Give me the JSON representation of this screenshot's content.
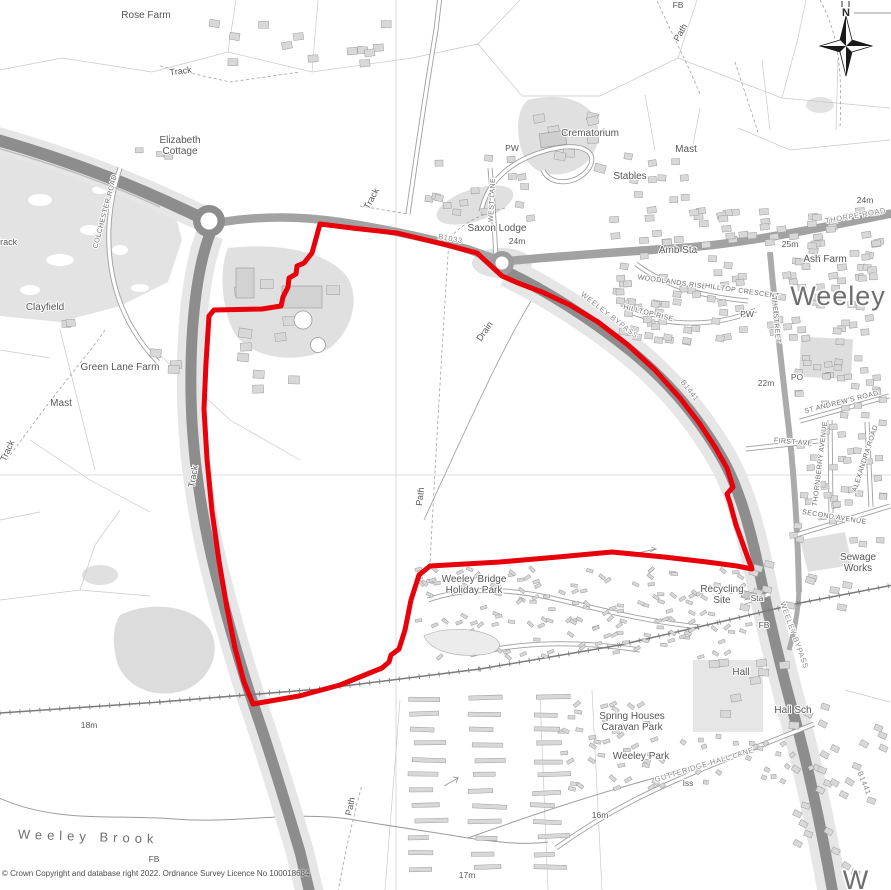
{
  "map": {
    "region_name": "Weeley",
    "copyright": "© Crown Copyright and database right 2022. Ordnance Survey Licence No 100018684",
    "compass": {
      "letter": "N"
    },
    "colors": {
      "boundary_red": "#e8000b",
      "road_major": "#8d8d8d",
      "road_secondary": "#a2a2a2",
      "verge_grey": "#e6e6e6",
      "building_grey": "#d8d8d8",
      "label_grey": "#575757"
    },
    "labels": [
      {
        "t": "Rose Farm",
        "x": 146,
        "y": 18
      },
      {
        "t": "Track",
        "x": 181,
        "y": 74,
        "r": -8,
        "s": 9
      },
      {
        "t": "Elizabeth\nCottage",
        "x": 180,
        "y": 143
      },
      {
        "t": "FB",
        "x": 678,
        "y": 8,
        "c": "small"
      },
      {
        "t": "Path",
        "x": 683,
        "y": 34,
        "r": -60,
        "s": 9
      },
      {
        "t": "Crematorium",
        "x": 590,
        "y": 136
      },
      {
        "t": "Mast",
        "x": 686,
        "y": 152
      },
      {
        "t": "Stables",
        "x": 630,
        "y": 179
      },
      {
        "t": "PW",
        "x": 512,
        "y": 151,
        "c": "small"
      },
      {
        "t": "Saxon Lodge",
        "x": 497,
        "y": 231
      },
      {
        "t": "24m",
        "x": 517,
        "y": 244,
        "c": "small"
      },
      {
        "t": "Amb Sta",
        "x": 678,
        "y": 253
      },
      {
        "t": "Ash Farm",
        "x": 825,
        "y": 262
      },
      {
        "t": "Weeley",
        "x": 838,
        "y": 305,
        "c": "big"
      },
      {
        "t": "WOODLANDS RISE",
        "x": 672,
        "y": 284,
        "r": 8,
        "c": "street"
      },
      {
        "t": "HILLTOP CRESCENT",
        "x": 742,
        "y": 293,
        "r": 8,
        "c": "street"
      },
      {
        "t": "HILLTOP RISE",
        "x": 648,
        "y": 315,
        "r": 14,
        "c": "street"
      },
      {
        "t": "PW",
        "x": 747,
        "y": 317,
        "c": "small"
      },
      {
        "t": "THE STREET",
        "x": 774,
        "y": 320,
        "r": 85,
        "c": "street"
      },
      {
        "t": "WEELEY BYPASS",
        "x": 608,
        "y": 317,
        "r": 38,
        "c": "road"
      },
      {
        "t": "B1033",
        "x": 450,
        "y": 241,
        "r": 10,
        "c": "road"
      },
      {
        "t": "25m",
        "x": 790,
        "y": 247,
        "c": "small"
      },
      {
        "t": "THORPE ROAD",
        "x": 856,
        "y": 218,
        "r": -10,
        "c": "road"
      },
      {
        "t": "24m",
        "x": 865,
        "y": 203,
        "c": "small"
      },
      {
        "t": "ST ANDREW'S ROAD",
        "x": 842,
        "y": 404,
        "r": -14,
        "c": "street"
      },
      {
        "t": "FIRST AVE",
        "x": 793,
        "y": 444,
        "r": 5,
        "c": "street"
      },
      {
        "t": "THORNBERRY AVENUE",
        "x": 822,
        "y": 464,
        "r": -83,
        "c": "street"
      },
      {
        "t": "ALEXANDRA ROAD",
        "x": 867,
        "y": 459,
        "r": -72,
        "c": "street"
      },
      {
        "t": "SECOND AVENUE",
        "x": 834,
        "y": 519,
        "r": 9,
        "c": "street"
      },
      {
        "t": "Sewage\nWorks",
        "x": 858,
        "y": 560
      },
      {
        "t": "Recycling\nSite",
        "x": 722,
        "y": 592
      },
      {
        "t": "Sta",
        "x": 757,
        "y": 601,
        "c": "small"
      },
      {
        "t": "FB",
        "x": 764,
        "y": 628,
        "c": "small"
      },
      {
        "t": "WEELEY BYPASS",
        "x": 792,
        "y": 636,
        "r": 70,
        "c": "road"
      },
      {
        "t": "Hall",
        "x": 741,
        "y": 675
      },
      {
        "t": "Hall Sch",
        "x": 793,
        "y": 713
      },
      {
        "t": "Spring Houses\nCaravan Park",
        "x": 632,
        "y": 719
      },
      {
        "t": "Weeley Park",
        "x": 641,
        "y": 759
      },
      {
        "t": "GUTTERIDGE HALL LANE",
        "x": 705,
        "y": 767,
        "r": -17,
        "c": "road"
      },
      {
        "t": "Iss",
        "x": 688,
        "y": 786,
        "c": "small"
      },
      {
        "t": "B1441",
        "x": 688,
        "y": 392,
        "r": 52,
        "c": "road"
      },
      {
        "t": "B1441",
        "x": 862,
        "y": 784,
        "r": 68,
        "c": "road"
      },
      {
        "t": "Weeley Bridge\nHoliday Park",
        "x": 474,
        "y": 582
      },
      {
        "t": "Path",
        "x": 423,
        "y": 497,
        "r": -83,
        "s": 9
      },
      {
        "t": "Drain",
        "x": 487,
        "y": 333,
        "r": -55,
        "s": 9
      },
      {
        "t": "Clayfield",
        "x": 45,
        "y": 310
      },
      {
        "t": "Green Lane Farm",
        "x": 120,
        "y": 370
      },
      {
        "t": "Mast",
        "x": 61,
        "y": 406
      },
      {
        "t": "Track",
        "x": 10,
        "y": 452,
        "r": -65,
        "s": 9
      },
      {
        "t": "Track",
        "x": 196,
        "y": 477,
        "r": -80,
        "s": 9
      },
      {
        "t": "COLCHESTER ROAD",
        "x": 107,
        "y": 212,
        "r": -75,
        "c": "street"
      },
      {
        "t": "Track",
        "x": 6,
        "y": 245,
        "s": 9
      },
      {
        "t": "Track",
        "x": 374,
        "y": 200,
        "r": -62,
        "s": 9
      },
      {
        "t": "WEST LANE",
        "x": 494,
        "y": 200,
        "r": -87,
        "c": "street"
      },
      {
        "t": "Weeley Brook",
        "x": 88,
        "y": 841,
        "r": 2,
        "c": "brook"
      },
      {
        "t": "FB",
        "x": 154,
        "y": 862,
        "c": "small"
      },
      {
        "t": "18m",
        "x": 89,
        "y": 728,
        "c": "small"
      },
      {
        "t": "17m",
        "x": 467,
        "y": 878,
        "c": "small"
      },
      {
        "t": "16m",
        "x": 600,
        "y": 818,
        "c": "small"
      },
      {
        "t": "22m",
        "x": 766,
        "y": 386,
        "c": "small"
      },
      {
        "t": "PO",
        "x": 797,
        "y": 380,
        "c": "small"
      },
      {
        "t": "Path",
        "x": 353,
        "y": 807,
        "r": -78,
        "s": 9
      },
      {
        "t": "N",
        "x": 846,
        "y": 16,
        "c": "compass"
      },
      {
        "t": "W",
        "x": 856,
        "y": 889,
        "c": "big"
      }
    ]
  }
}
